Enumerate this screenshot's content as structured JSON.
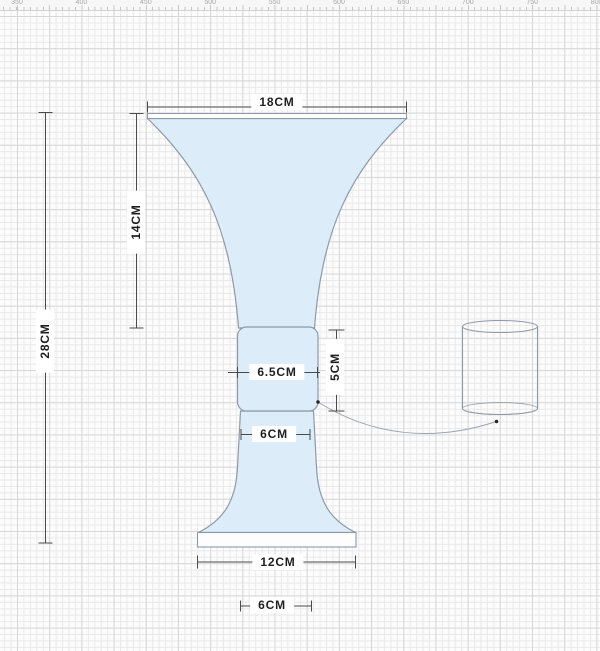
{
  "ruler": {
    "labels": [
      "350",
      "400",
      "450",
      "500",
      "550",
      "600",
      "650",
      "700",
      "750",
      "800"
    ],
    "start_value": 350,
    "step": 50,
    "start_x": 17,
    "px_per_step": 64.4
  },
  "dimensions": {
    "top_width": {
      "label": "18CM"
    },
    "bell_height": {
      "label": "14CM"
    },
    "total_height": {
      "label": "28CM"
    },
    "neck_width": {
      "label": "6.5CM"
    },
    "neck_height": {
      "label": "5CM"
    },
    "stem_width": {
      "label": "6CM"
    },
    "base_width": {
      "label": "12CM"
    },
    "base_bottom_width": {
      "label": "6CM"
    }
  },
  "colors": {
    "shape_fill": "#dcecf9",
    "shape_outline": "#8d99a6",
    "rim_fill": "#ffffff",
    "base_fill": "#fdfdfd",
    "dimension_line": "#4a4a4a",
    "leader_line": "#9aa5b0",
    "leader_dot": "#2a2a2a",
    "label_text": "#1f1f1f",
    "label_bg": "#ffffff",
    "grid_minor": "#e9e9e9",
    "grid_major": "#d7d7d7",
    "canvas_bg": "#fcfcfc",
    "ruler_bg": "#f7f7f7",
    "ruler_text": "#a6a6a6"
  }
}
